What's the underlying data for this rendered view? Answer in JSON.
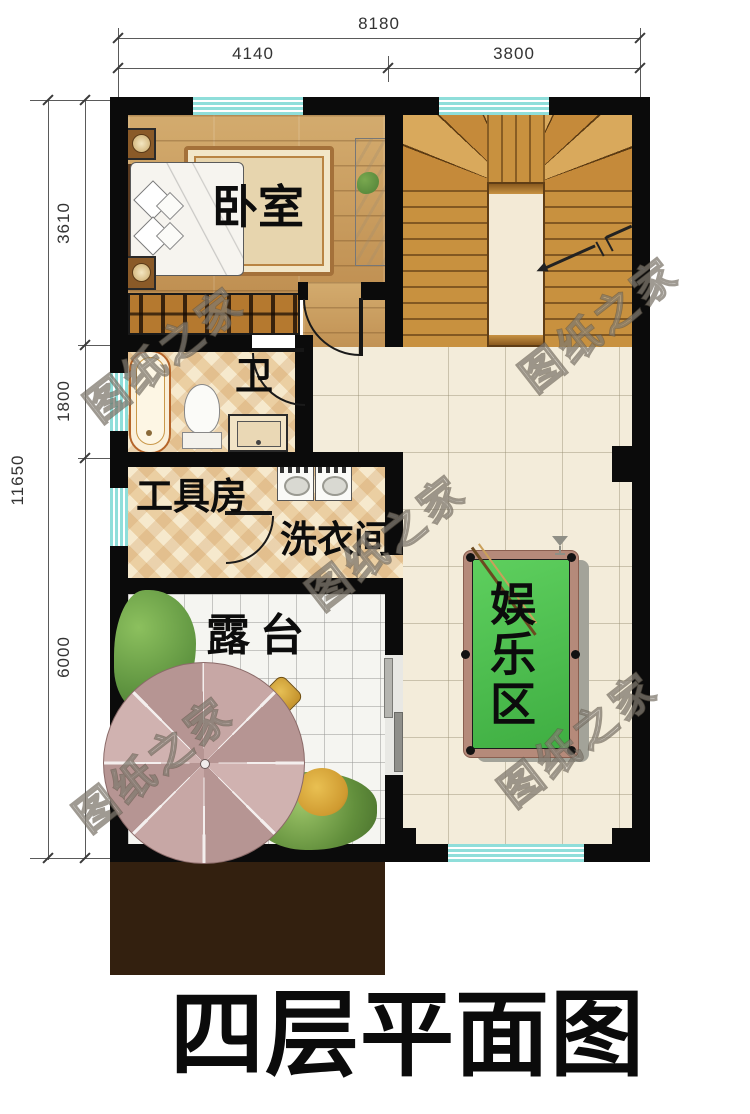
{
  "title": "四层平面图",
  "watermark": {
    "text": "图纸之家"
  },
  "dimensions": {
    "top_total": "8180",
    "top_segments": [
      "4140",
      "3800"
    ],
    "left_total": "11650",
    "left_segments": [
      "3610",
      "1800",
      "6000"
    ]
  },
  "rooms": {
    "bedroom": "卧室",
    "bathroom": "卫",
    "tool_room": "工具房",
    "laundry": "洗衣间",
    "terrace": "露台",
    "entertainment": "娱乐区"
  },
  "colors": {
    "wall": "#0b0b0b",
    "window_glass": "#8fdeda",
    "wood_floor": "#c99f60",
    "stair_wood": "#c8913f",
    "tile_warm": "#f0dcb8",
    "tile_hall": "#f3ecda",
    "tile_terrace": "#f5f5f1",
    "pool_felt": "#4fc654",
    "pool_rim": "#b58a7a",
    "umbrella": "#c3a2a0",
    "roof_block": "#33200f"
  }
}
